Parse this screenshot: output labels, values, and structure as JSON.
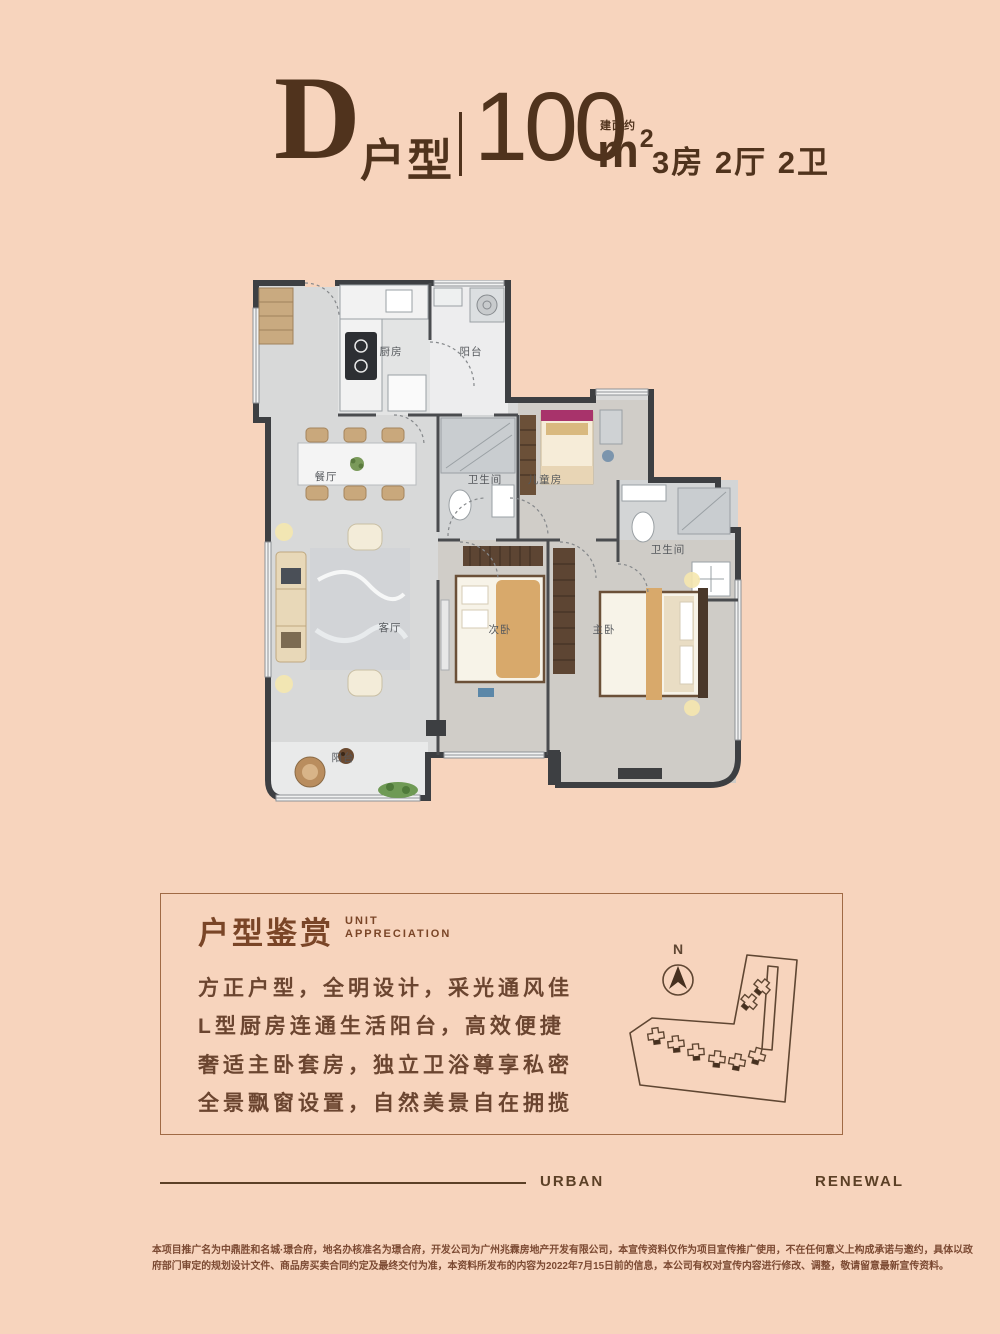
{
  "page": {
    "background": "#f7d4bd",
    "accent_brown": "#50331d"
  },
  "header": {
    "unit_letter": "D",
    "unit_type_label": "户型",
    "area_note": "建面约",
    "area_value": "100",
    "area_unit": "m",
    "area_unit_sup": "2",
    "layout_spec": "3房 2厅 2卫"
  },
  "floorplan": {
    "rooms": [
      {
        "label": "厨房"
      },
      {
        "label": "阳台"
      },
      {
        "label": "餐厅"
      },
      {
        "label": "卫生间"
      },
      {
        "label": "儿童房"
      },
      {
        "label": "卫生间"
      },
      {
        "label": "客厅"
      },
      {
        "label": "次卧"
      },
      {
        "label": "主卧"
      },
      {
        "label": "阳台"
      }
    ]
  },
  "appreciation": {
    "title_cn": "户型鉴赏",
    "title_en_line1": "UNIT",
    "title_en_line2": "APPRECIATION",
    "features": [
      "方正户型，全明设计，采光通风佳",
      "L型厨房连通生活阳台，高效便捷",
      "奢适主卧套房，独立卫浴尊享私密",
      "全景飘窗设置，自然美景自在拥揽"
    ],
    "compass_label": "N"
  },
  "footer": {
    "word_left": "URBAN",
    "word_right": "RENEWAL",
    "disclaimer_line1": "本项目推广名为中鼎胜和名城·璟合府，地名办核准名为璟合府，开发公司为广州兆霖房地产开发有限公司，本宣传资料仅作为项目宣传推广使用，不在任何意义上构成承诺与邀约，具体以政",
    "disclaimer_line2": "府部门审定的规划设计文件、商品房买卖合同约定及最终交付为准，本资料所发布的内容为2022年7月15日前的信息，本公司有权对宣传内容进行修改、调整，敬请留意最新宣传资料。"
  }
}
